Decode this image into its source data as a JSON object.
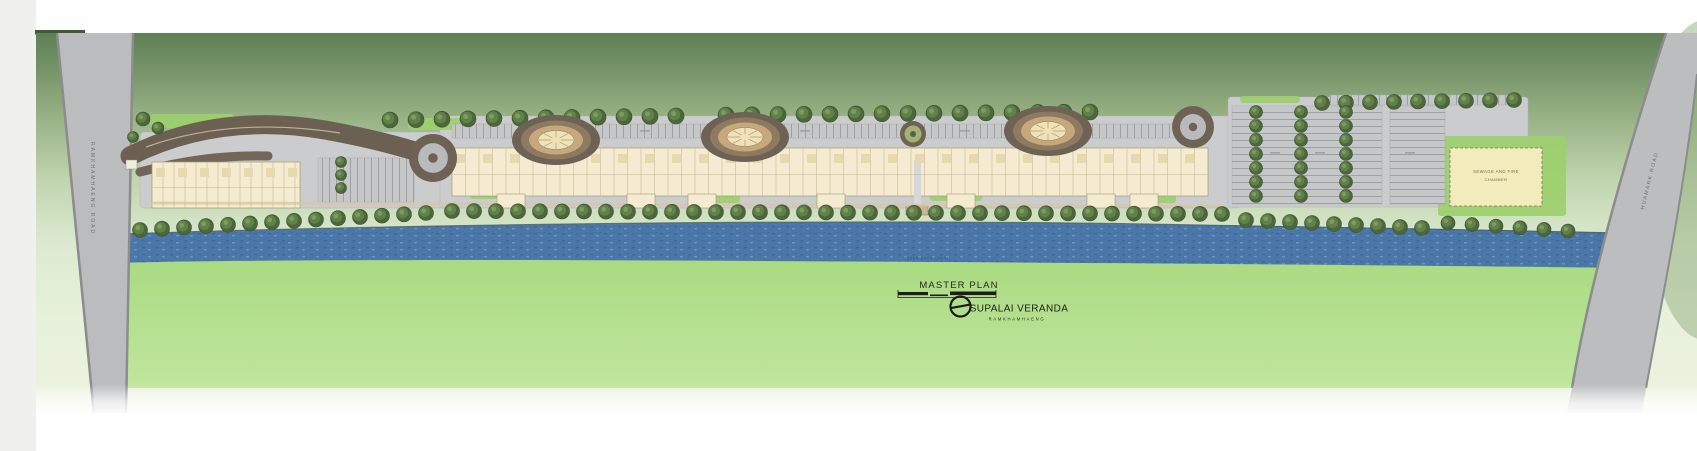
{
  "page": {
    "background": "#ffffff",
    "left_margin_color": "#f0f1ee",
    "accent_bar_color": "#3d5c33"
  },
  "title_block": {
    "title": "MASTER PLAN",
    "project_name": "SUPALAI VERANDA",
    "project_location": "RAMKHAMHAENG",
    "logo": "supalai-circle-logo"
  },
  "roads": {
    "left_vertical": "RAMKHAMHAENG ROAD",
    "right_diagonal": "HUAMARK ROAD"
  },
  "water": {
    "label": "SAEN SAEB CANAL"
  },
  "site_labels": {
    "utility_line1": "SEWAGE AND FIRE",
    "utility_line2": "CHAMBER"
  },
  "colors": {
    "canopy_top": "#5f7f55",
    "canopy_fade": "#ecf3e1",
    "field_green_top": "#a9da80",
    "field_green_bottom": "#c0e69e",
    "water_blue": "#4a77a7",
    "road_gray": "#bbbcbe",
    "road_edge": "#8b8c8e",
    "site_gray": "#cbccce",
    "building_cream": "#f4ebd1",
    "building_outline": "#a59873",
    "tower_dark": "#6e6254",
    "tower_mid": "#8d7a61",
    "tower_tan": "#c7a87c",
    "tower_cream": "#f0e2b8",
    "tree_dark": "#4c673c",
    "tree_mid": "#61804a",
    "tree_light": "#7fa05e",
    "landscape_green": "#9ccf6d",
    "drive_dark": "#6b6052",
    "path_tan": "#d8c7a0",
    "utility_yellow": "#f2ecbc",
    "ink": "#262a1f"
  },
  "drawing": {
    "towers": [
      {
        "cx": 556,
        "cy": 140
      },
      {
        "cx": 745,
        "cy": 137
      },
      {
        "cx": 1048,
        "cy": 131
      }
    ],
    "center_ring": {
      "cx": 913,
      "cy": 134
    },
    "roundabouts": [
      {
        "cx": 433,
        "cy": 158,
        "r": 24
      },
      {
        "cx": 1193,
        "cy": 127,
        "r": 21
      }
    ],
    "main_building": {
      "x": 452,
      "y": 148,
      "w": 756,
      "h": 48,
      "div": 13.5
    },
    "shops_building": {
      "x": 152,
      "y": 162,
      "w": 148,
      "h": 46,
      "div": 11
    },
    "building_wings": [
      497,
      627,
      688,
      817,
      947,
      1087,
      1130
    ],
    "parking_lots": [
      {
        "x": 318,
        "y": 158,
        "w": 96,
        "h": 44,
        "dir": "h"
      },
      {
        "x": 452,
        "y": 124,
        "w": 740,
        "h": 14,
        "dir": "h"
      },
      {
        "x": 1232,
        "y": 106,
        "w": 150,
        "h": 98,
        "dir": "v"
      },
      {
        "x": 1390,
        "y": 106,
        "w": 55,
        "h": 98,
        "dir": "v"
      },
      {
        "x": 1330,
        "y": 95,
        "w": 185,
        "h": 10,
        "dir": "h"
      }
    ],
    "label_marks": [
      [
        520,
        130
      ],
      [
        640,
        130
      ],
      [
        800,
        130
      ],
      [
        960,
        130
      ],
      [
        1080,
        130
      ],
      [
        1270,
        152
      ],
      [
        1315,
        152
      ],
      [
        1405,
        152
      ]
    ],
    "green_patches": [
      {
        "x": 150,
        "y": 114,
        "w": 84,
        "h": 14
      },
      {
        "x": 244,
        "y": 124,
        "w": 52,
        "h": 10
      },
      {
        "x": 408,
        "y": 118,
        "w": 64,
        "h": 12
      },
      {
        "x": 470,
        "y": 190,
        "w": 28,
        "h": 9
      },
      {
        "x": 700,
        "y": 194,
        "w": 40,
        "h": 9
      },
      {
        "x": 930,
        "y": 190,
        "w": 52,
        "h": 11
      },
      {
        "x": 1140,
        "y": 194,
        "w": 36,
        "h": 9
      },
      {
        "x": 1240,
        "y": 96,
        "w": 60,
        "h": 7
      },
      {
        "x": 1438,
        "y": 136,
        "w": 128,
        "h": 80
      }
    ],
    "tree_rows": [
      {
        "x1": 390,
        "x2": 700,
        "step": 26,
        "y1": 120,
        "y2": 116,
        "r": 8
      },
      {
        "x1": 726,
        "x2": 1110,
        "step": 26,
        "y1": 115,
        "y2": 112,
        "r": 8
      },
      {
        "x1": 1322,
        "x2": 1518,
        "step": 24,
        "y1": 103,
        "y2": 100,
        "r": 7.5
      },
      {
        "x1": 140,
        "x2": 430,
        "step": 22,
        "y1": 230,
        "y2": 213,
        "r": 7.5
      },
      {
        "x1": 452,
        "x2": 1230,
        "step": 22,
        "y1": 211,
        "y2": 214,
        "r": 7.5
      },
      {
        "x1": 1246,
        "x2": 1430,
        "step": 22,
        "y1": 220,
        "y2": 228,
        "r": 7.5
      },
      {
        "x1": 1448,
        "x2": 1568,
        "step": 24,
        "y1": 223,
        "y2": 231,
        "r": 7
      }
    ],
    "tree_cols": [
      {
        "x": 341,
        "y1": 162,
        "y2": 200,
        "step": 13,
        "r": 5.5
      },
      {
        "x": 1256,
        "y1": 112,
        "y2": 200,
        "step": 14,
        "r": 6.5
      },
      {
        "x": 1301,
        "y1": 112,
        "y2": 200,
        "step": 14,
        "r": 6.5
      },
      {
        "x": 1346,
        "y1": 112,
        "y2": 200,
        "step": 14,
        "r": 6.5
      }
    ],
    "scattered_trees": [
      {
        "x": 143,
        "y": 119,
        "r": 7
      },
      {
        "x": 158,
        "y": 128,
        "r": 6
      },
      {
        "x": 133,
        "y": 137,
        "r": 5.5
      }
    ]
  }
}
